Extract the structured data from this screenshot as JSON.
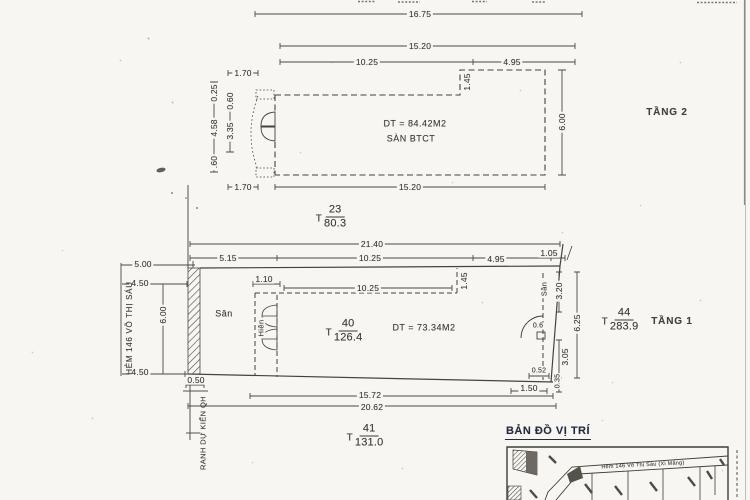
{
  "floor2": {
    "name": "TẦNG 2",
    "area": "DT = 84.42M2",
    "slab": "SÀN BTCT",
    "dim_16_75": "16.75",
    "dim_15_20": "15.20",
    "dim_10_25": "10.25",
    "dim_4_95": "4.95",
    "dim_1_70_top": "1.70",
    "dim_1_45": "1.45",
    "dim_6_00": "6.00",
    "dim_0_25": "0.25",
    "dim_0_60": "0.60",
    "dim_4_58": "4.58",
    "dim_3_35": "3.35",
    "dim_0_60_b": ".60",
    "dim_1_70_bot": "1.70",
    "dim_15_20_bot": "15.20"
  },
  "parcel23": {
    "t": "T",
    "num": "23",
    "den": "80.3"
  },
  "floor1": {
    "name": "TẦNG 1",
    "area": "DT = 73.34M2",
    "yard_left": "Sân",
    "porch": "Hiên",
    "yard_right": "Sân",
    "dim_21_40": "21.40",
    "dim_5_15": "5.15",
    "dim_10_25": "10.25",
    "dim_4_95": "4.95",
    "dim_1_05": "1.05",
    "dim_1_10": "1.10",
    "dim_10_25_inner": "10.25",
    "dim_1_45": "1.45",
    "dim_5_00": "5.00",
    "dim_4_50_top": "4.50",
    "dim_6_00": "6.00",
    "dim_4_50_bot": "4.50",
    "dim_0_50": "0.50",
    "dim_3_20": "3.20",
    "dim_6_25": "6.25",
    "dim_3_05": "3.05",
    "dim_0_35": "0.35",
    "dim_0_52": "0.52",
    "dim_0_6": "0.6",
    "dim_1_50": "1.50",
    "dim_15_72": "15.72",
    "dim_20_62": "20.62"
  },
  "parcel40": {
    "t": "T",
    "num": "40",
    "den": "126.4"
  },
  "parcel44": {
    "t": "T",
    "num": "44",
    "den": "283.9"
  },
  "parcel41": {
    "t": "T",
    "num": "41",
    "den": "131.0"
  },
  "street": "HẺM 146 VÕ THỊ SÁU",
  "boundary": "RANH DỰ KIẾN QH",
  "map": {
    "title": "BẢN ĐỒ VỊ TRÍ",
    "street": "Hẻm 146   Võ Thị Sáu   (Xi Măng)"
  },
  "colors": {
    "ink": "#4b4841",
    "paper": "#f7f6f2",
    "map_title_ink": "#262b40"
  }
}
